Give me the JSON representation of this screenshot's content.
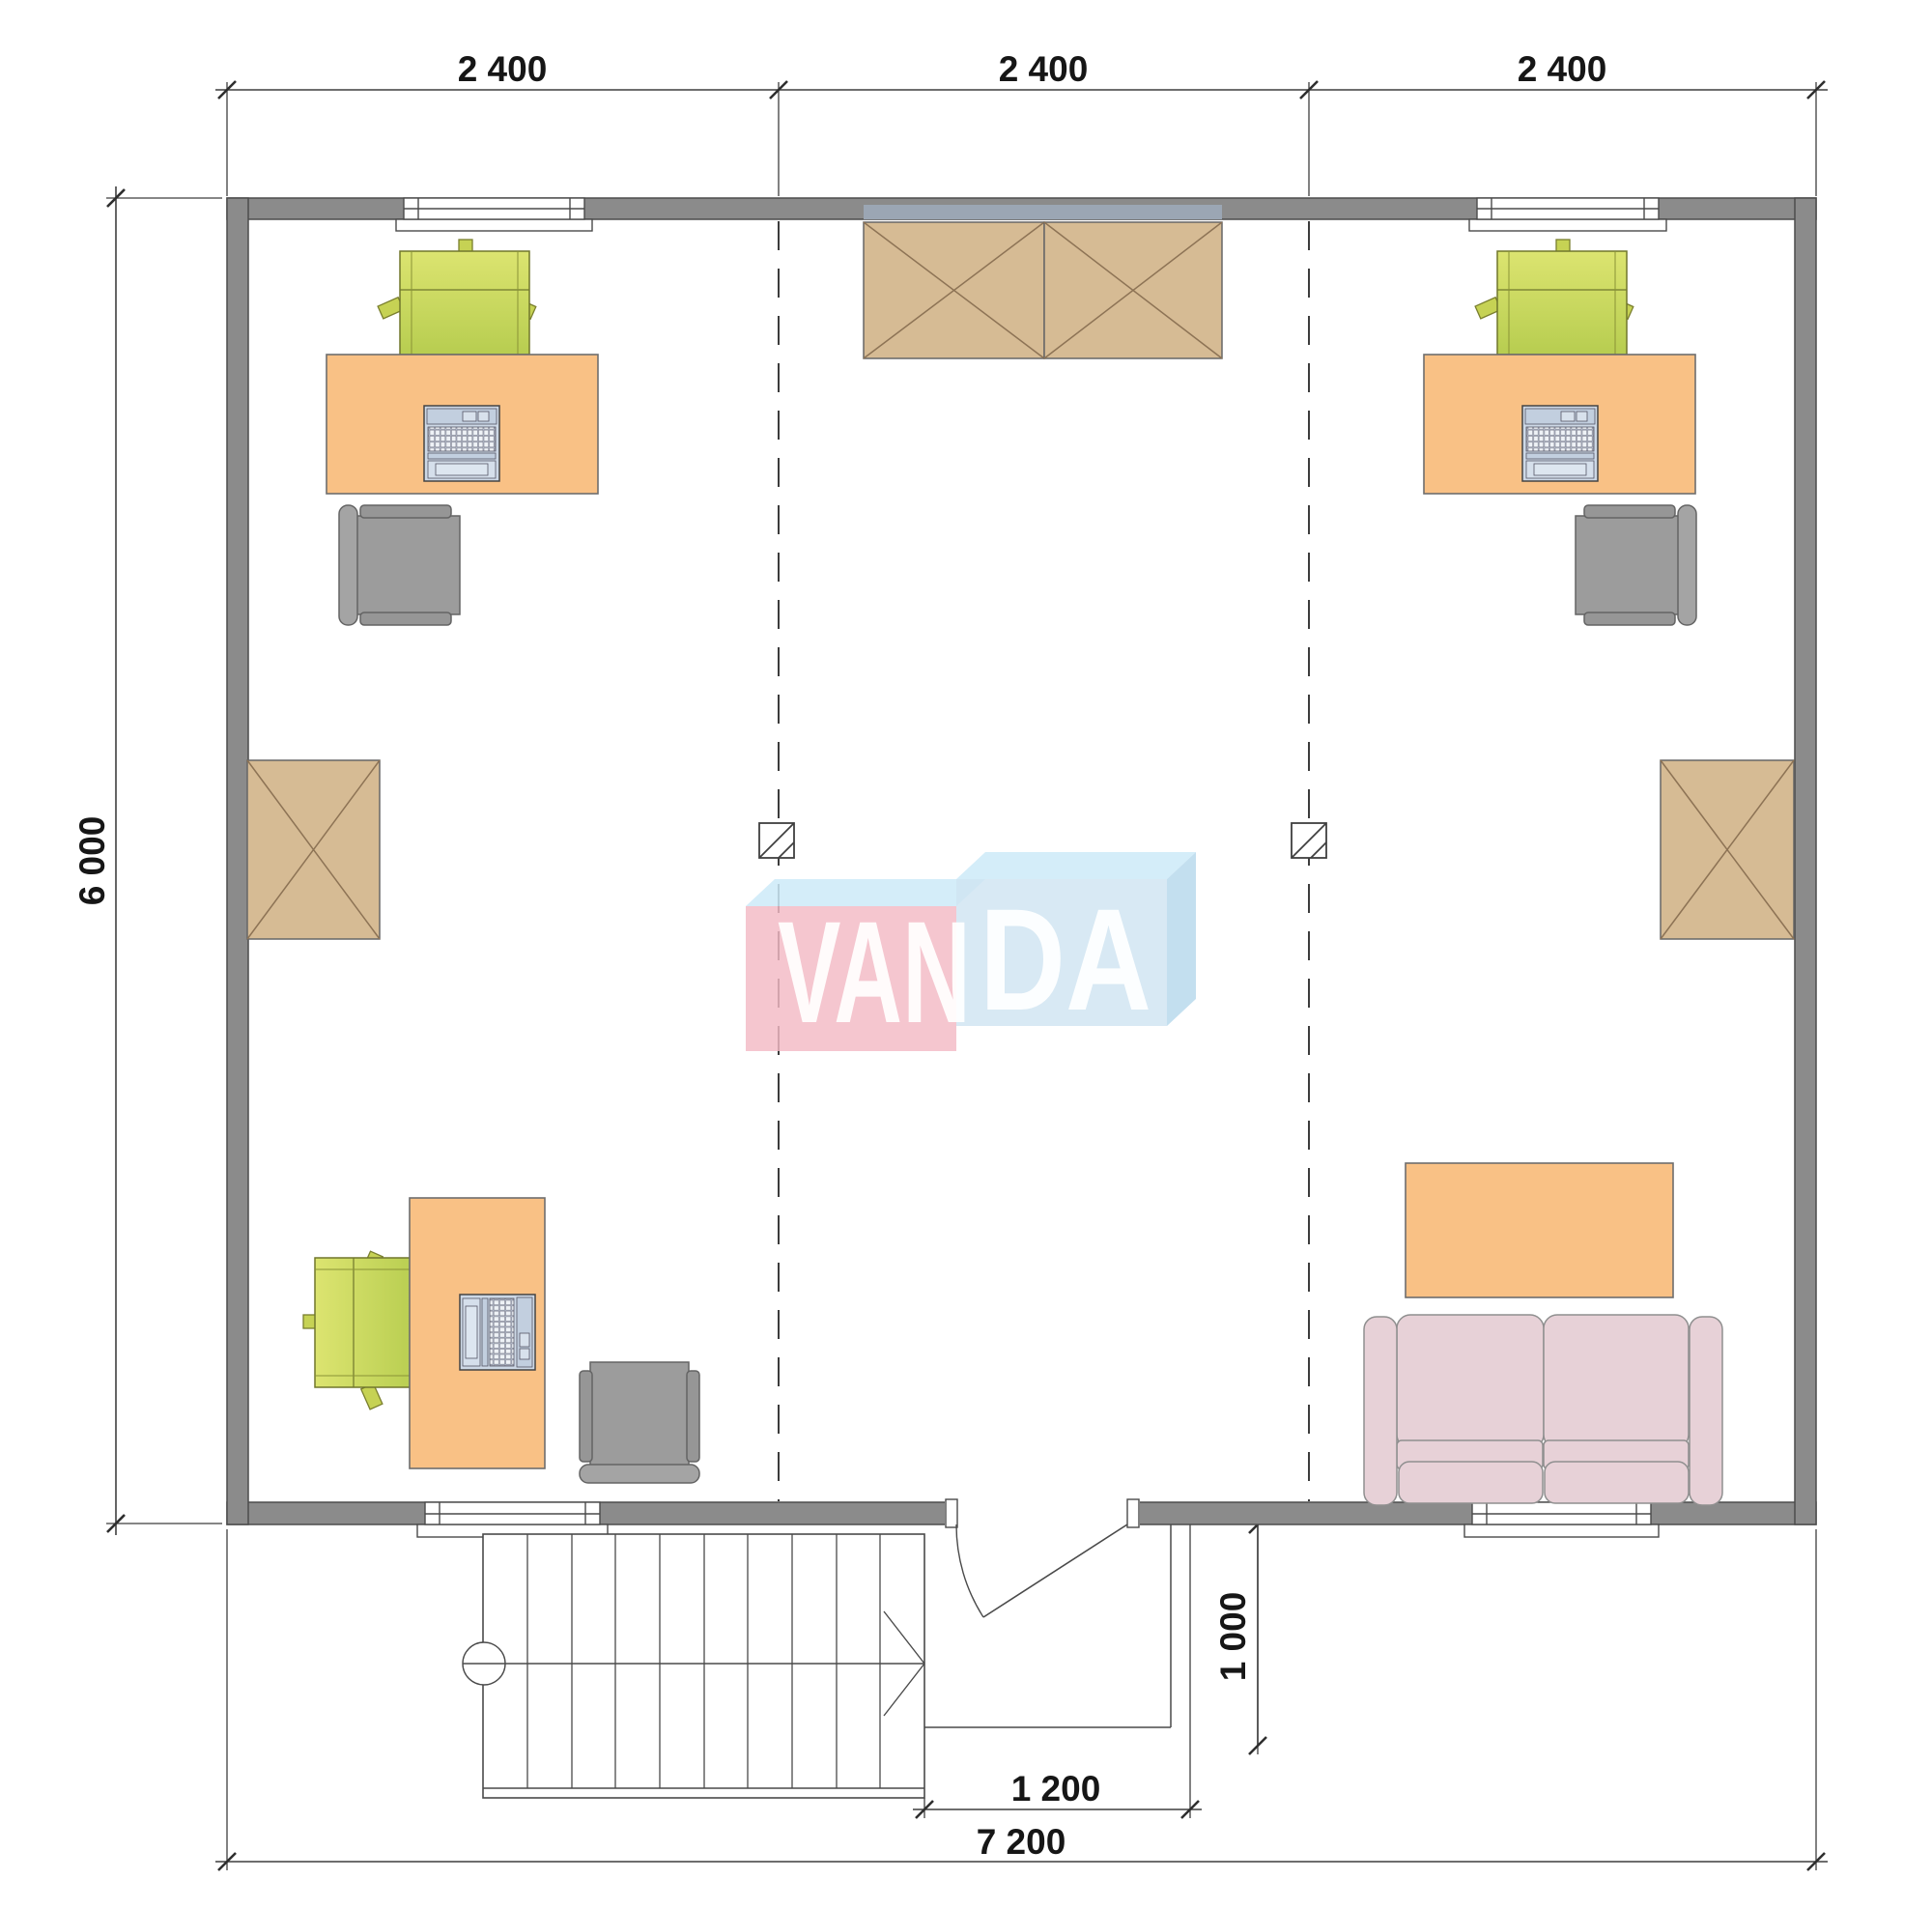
{
  "drawing": {
    "type": "architectural-floor-plan",
    "room_sections": 3,
    "storey_items": [
      "two office workstations top",
      "one office workstation bottom-left",
      "sofa and coffee table bottom-right",
      "four crossed storage cabinets",
      "exterior stair with up-arrow",
      "entry door with swing",
      "entry porch"
    ]
  },
  "dims": {
    "top_labels": [
      "2 400",
      "2 400",
      "2 400"
    ],
    "height_label": "6 000",
    "entry_width_label": "1 200",
    "total_width_label": "7 200",
    "porch_depth_label": "1 000"
  },
  "watermark": {
    "text_left": "VAN",
    "text_right": "DA",
    "pink_block": "#f3bac4",
    "blue_block": "#cfe4f1",
    "bevel_top": "#cdeaf8",
    "bevel_side": "#b9d9ec"
  },
  "colors": {
    "wall_fill": "#8b8b8b",
    "wall_stroke": "#4c4c4c",
    "desk": "#f9c185",
    "chair_green_light": "#dce470",
    "chair_green_dark": "#b7cd50",
    "task_chair": "#9c9c9c",
    "cabinet": "#d6bb94",
    "cabinet_cross": "#8d7355",
    "sofa": "#e7d1d7",
    "laptop": "#cdd8e6",
    "dimension_line": "#3f3f3f"
  }
}
